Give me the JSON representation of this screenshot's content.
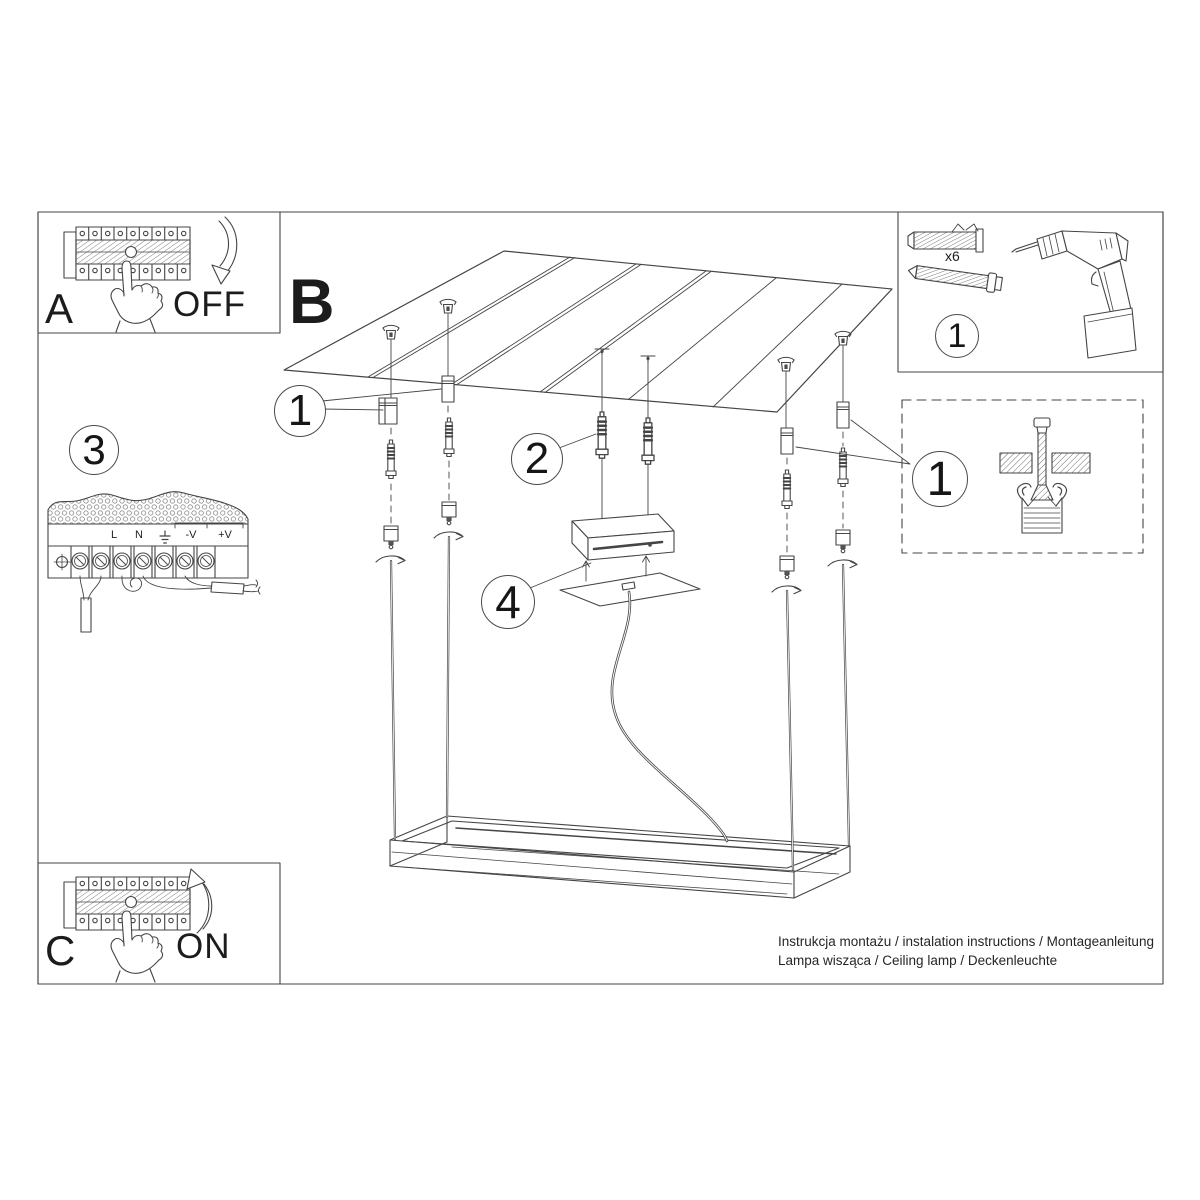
{
  "sheet": {
    "panel_a": {
      "letter": "A",
      "action": "OFF"
    },
    "panel_b": {
      "letter": "B"
    },
    "panel_c": {
      "letter": "C",
      "action": "ON"
    },
    "tools_box": {
      "marker": "1",
      "quantity": "x6"
    },
    "detail_box": {
      "marker": "1"
    },
    "markers": {
      "step1": "1",
      "step2": "2",
      "step3": "3",
      "step4": "4"
    },
    "driver": {
      "terminals": {
        "l": "L",
        "n": "N",
        "neg": "-V",
        "pos": "+V"
      }
    },
    "footer": {
      "line1": "Instrukcja montażu / instalation instructions / Montageanleitung",
      "line2": "Lampa wisząca / Ceiling lamp / Deckenleuchte"
    },
    "colors": {
      "line": "#454545",
      "text": "#1c1c1c",
      "background": "#ffffff"
    }
  }
}
